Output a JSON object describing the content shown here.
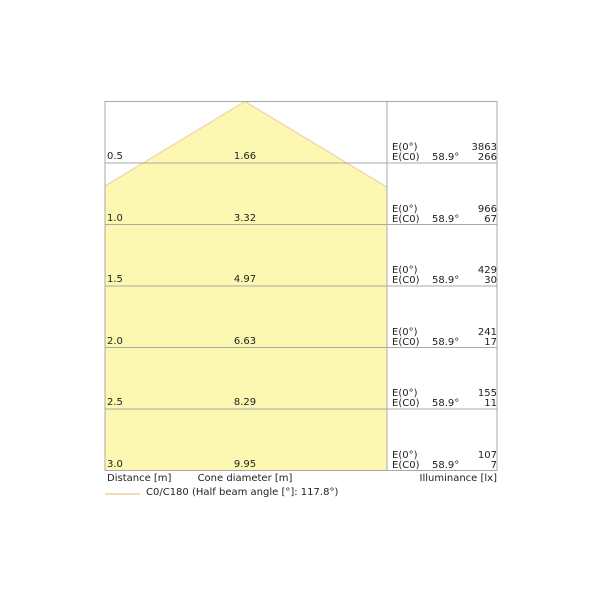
{
  "chart_data": {
    "type": "area",
    "description": "photometric-cone-diagram",
    "distances_m": [
      0.5,
      1.0,
      1.5,
      2.0,
      2.5,
      3.0
    ],
    "cone_diameters_m": [
      1.66,
      3.32,
      4.97,
      6.63,
      8.29,
      9.95
    ],
    "illuminance_e0_lx": [
      3863,
      966,
      429,
      241,
      155,
      107
    ],
    "illuminance_ec0_lx": [
      266,
      67,
      30,
      17,
      11,
      7
    ],
    "half_beam_angle_deg": 117.8,
    "axis": {
      "distance": "Distance [m]",
      "cone_diameter": "Cone diameter [m]",
      "illuminance": "Illuminance [lx]"
    },
    "legend": {
      "label": "C0/C180 (Half beam angle [°]: 117.8°)"
    },
    "rows": [
      {
        "distance": "0.5",
        "diameter": "1.66",
        "e0_label": "E(0°)",
        "ec0_label": "E(C0)",
        "angle": "58.9°",
        "e0": "3863",
        "ec0": "266"
      },
      {
        "distance": "1.0",
        "diameter": "3.32",
        "e0_label": "E(0°)",
        "ec0_label": "E(C0)",
        "angle": "58.9°",
        "e0": "966",
        "ec0": "67"
      },
      {
        "distance": "1.5",
        "diameter": "4.97",
        "e0_label": "E(0°)",
        "ec0_label": "E(C0)",
        "angle": "58.9°",
        "e0": "429",
        "ec0": "30"
      },
      {
        "distance": "2.0",
        "diameter": "6.63",
        "e0_label": "E(0°)",
        "ec0_label": "E(C0)",
        "angle": "58.9°",
        "e0": "241",
        "ec0": "17"
      },
      {
        "distance": "2.5",
        "diameter": "8.29",
        "e0_label": "E(0°)",
        "ec0_label": "E(C0)",
        "angle": "58.9°",
        "e0": "155",
        "ec0": "11"
      },
      {
        "distance": "3.0",
        "diameter": "9.95",
        "e0_label": "E(0°)",
        "ec0_label": "E(C0)",
        "angle": "58.9°",
        "e0": "107",
        "ec0": "7"
      }
    ],
    "colors": {
      "cone_fill": "#fcf8b2",
      "cone_edge": "#f0d2a8",
      "legend_line": "#f2dabb",
      "grid": "#a8a8a8",
      "text": "#222222"
    }
  }
}
